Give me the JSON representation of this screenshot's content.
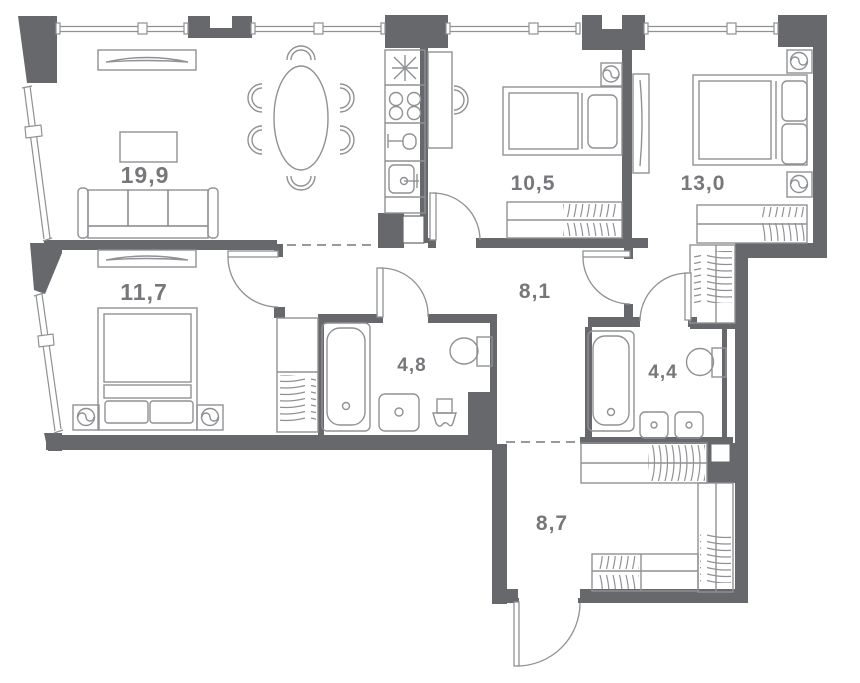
{
  "plan": {
    "type": "apartment-floor-plan",
    "rooms": [
      {
        "id": "living-room",
        "area_label": "19,9"
      },
      {
        "id": "bedroom-1",
        "area_label": "11,7"
      },
      {
        "id": "bedroom-2",
        "area_label": "10,5"
      },
      {
        "id": "bedroom-3",
        "area_label": "13,0"
      },
      {
        "id": "hallway",
        "area_label": "8,1"
      },
      {
        "id": "bathroom-1",
        "area_label": "4,8"
      },
      {
        "id": "bathroom-2",
        "area_label": "4,4"
      },
      {
        "id": "entry-hall",
        "area_label": "8,7"
      }
    ],
    "colors": {
      "wall": "#66686b",
      "furniture_line": "#8f9194",
      "label": "#76777a",
      "dashed_opening": "#8a8b8d",
      "background": "#ffffff"
    }
  }
}
